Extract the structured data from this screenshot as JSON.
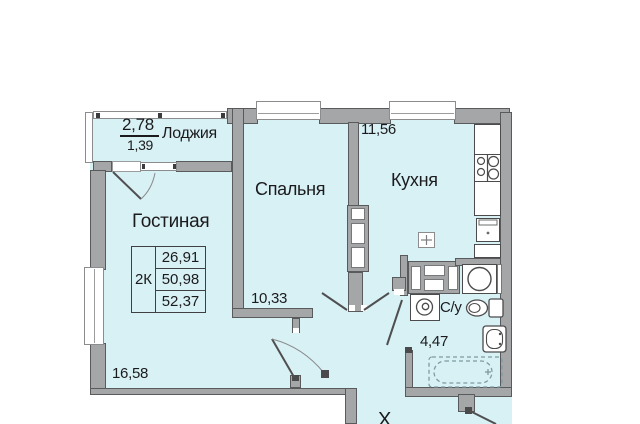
{
  "plan_title": "2K apartment floor plan",
  "loggia": {
    "label": "Лоджия",
    "area_top": "2,78",
    "area_bottom": "1,39"
  },
  "living": {
    "label": "Гостиная",
    "area": "16,58"
  },
  "bedroom": {
    "label": "Спальня",
    "area": "10,33"
  },
  "kitchen": {
    "label": "Кухня",
    "area": "11,56"
  },
  "bathroom": {
    "label": "С/у",
    "area": "4,47"
  },
  "hall": {
    "label": "Х"
  },
  "summary": {
    "type": "2К",
    "rows": [
      "26,91",
      "50,98",
      "52,37"
    ]
  },
  "colors": {
    "room_fill": "#d8f1f5",
    "wall": "#a5a6a8",
    "wall_edge": "#595a5c",
    "text": "#1b1b1d",
    "fixture_stroke": "#4b4b4d",
    "window_frame": "#8b8c8e"
  }
}
